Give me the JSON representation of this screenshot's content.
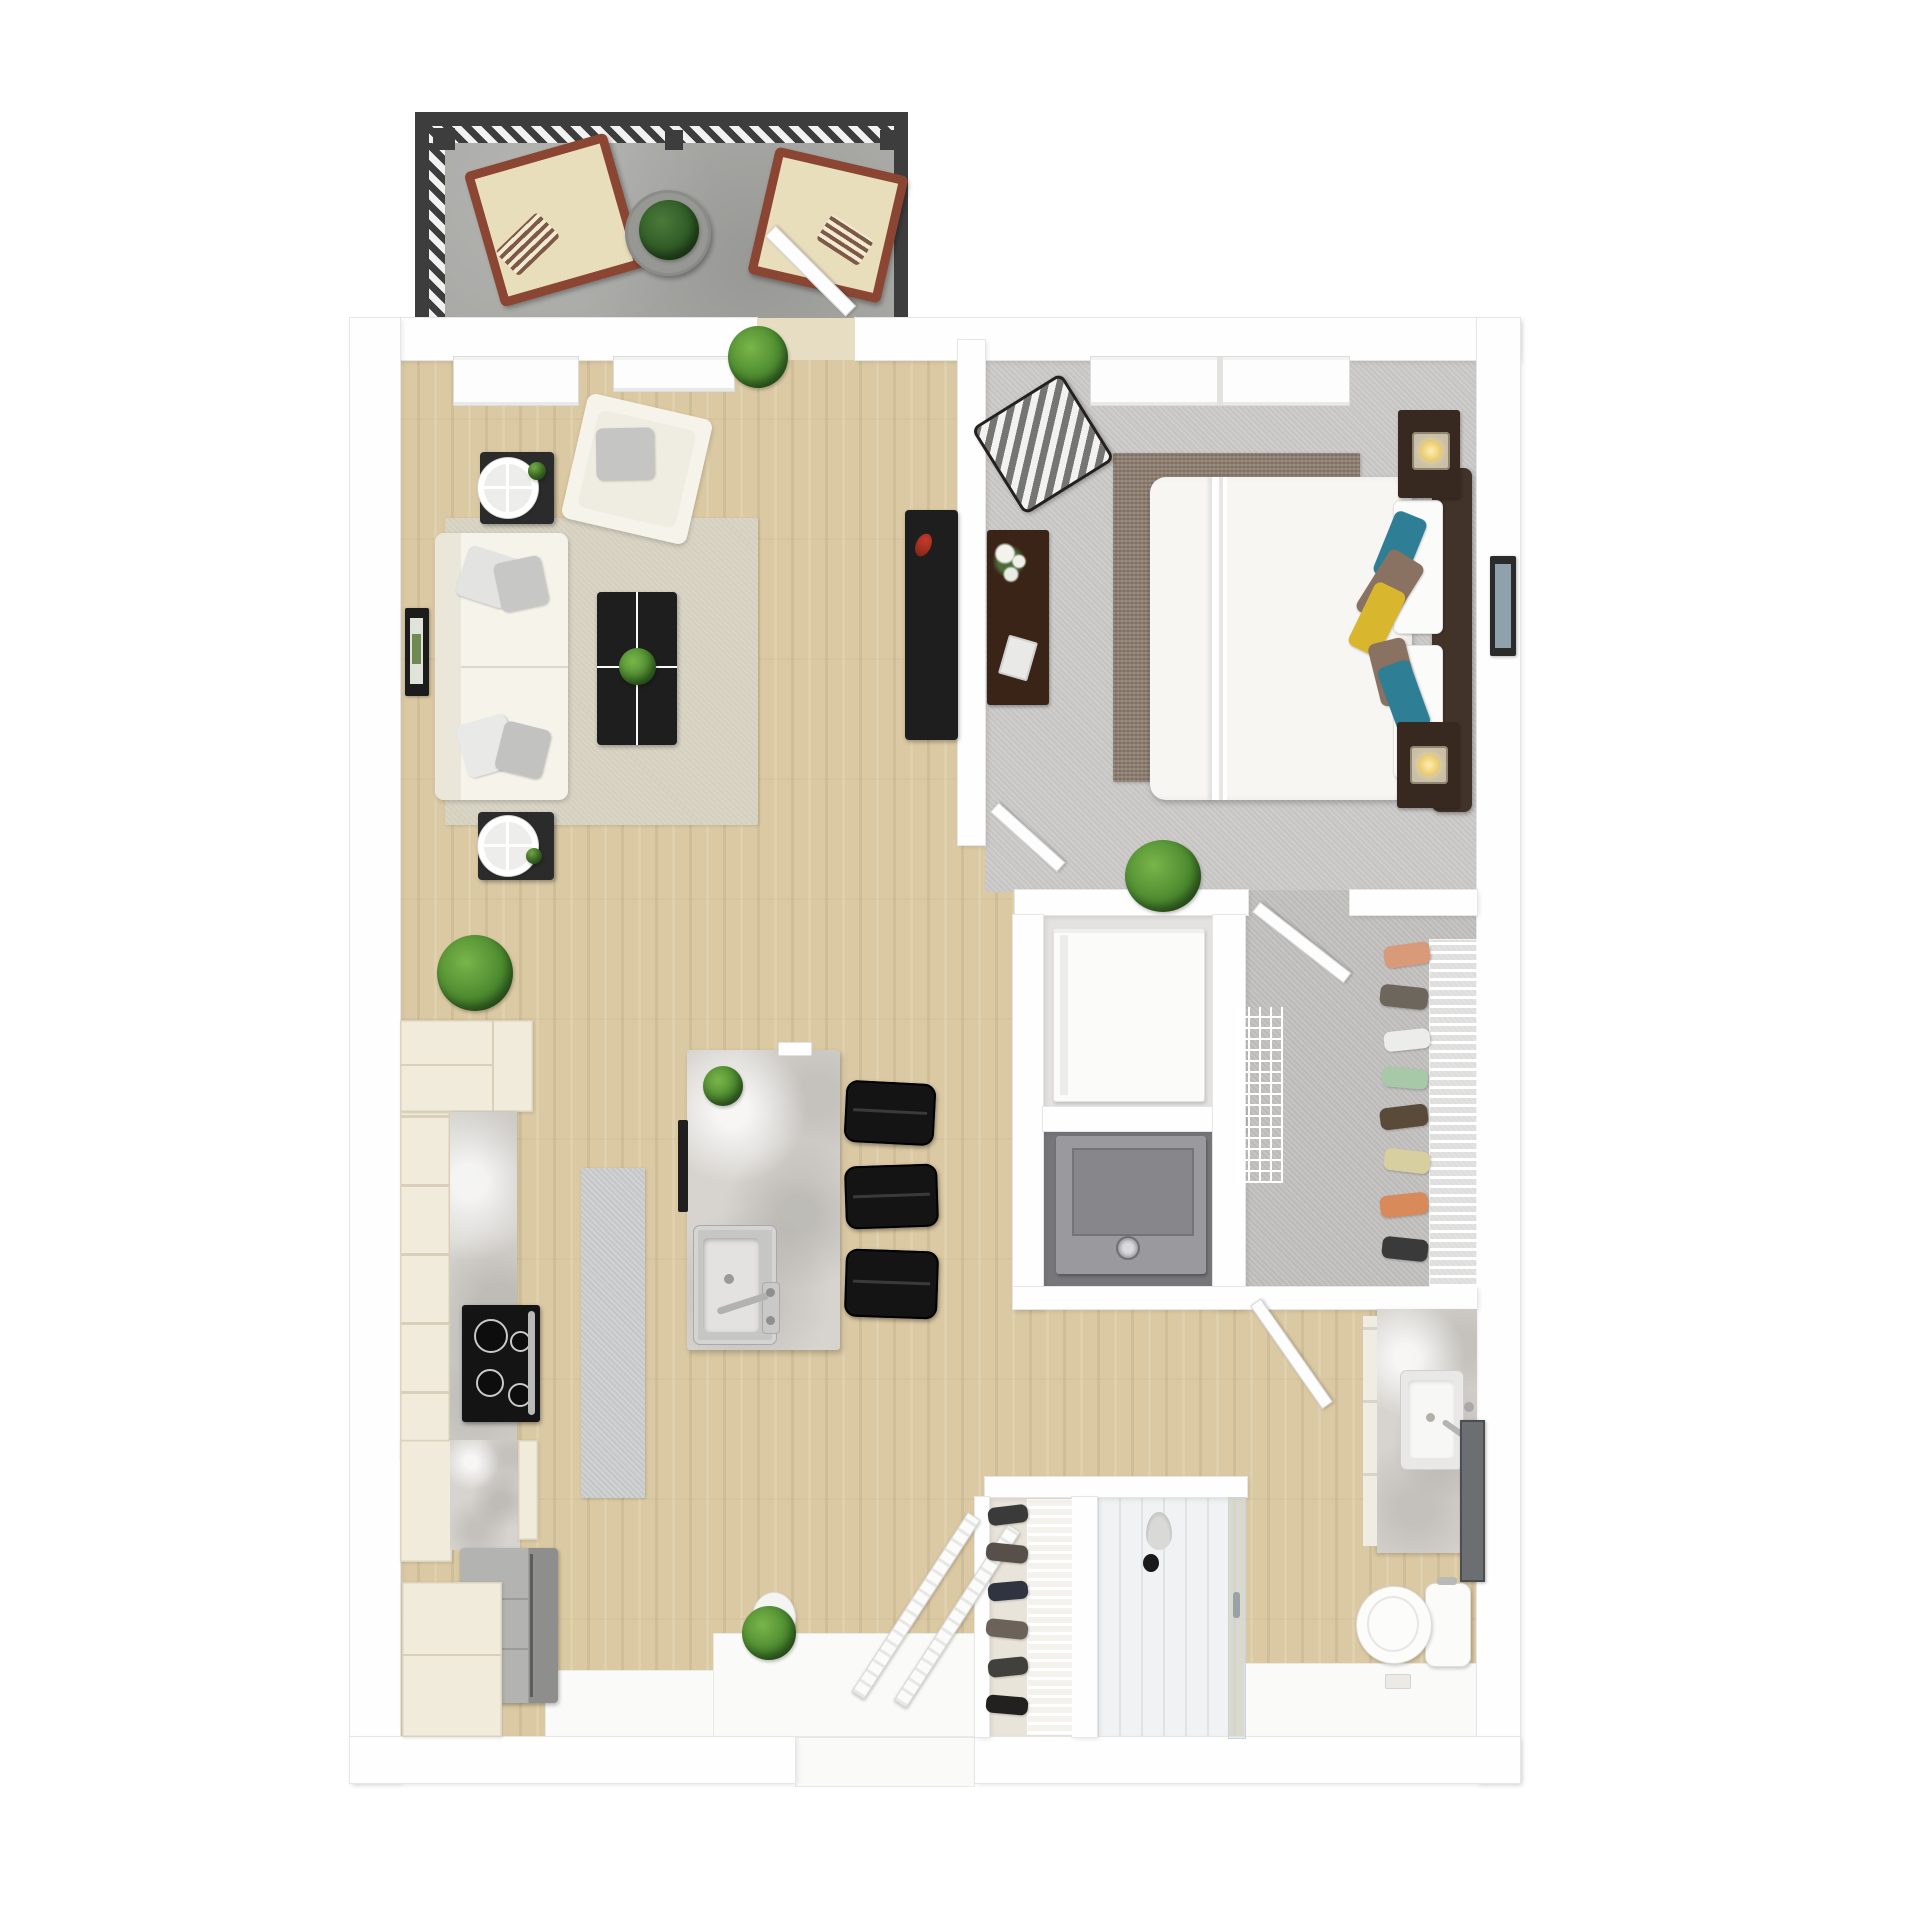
{
  "meta": {
    "label": "Top-down 3D rendered floor plan of a one-bedroom apartment with balcony",
    "render_style": "3d-dollhouse"
  },
  "palette": {
    "wall": "#fefefe",
    "wood_floor": "#dbc9a3",
    "bedroom_carpet": "#cbcac8",
    "closet_carpet": "#c2c1bf",
    "balcony_concrete": "#a9a9a6",
    "marble_counter": "#d7d4cf",
    "living_rug": "#d8d3c3",
    "bedroom_rug": "#8b7b6d",
    "runner_rug": "#caccce",
    "cream_cabinet": "#f1ebdb",
    "dark_wood": "#37291f",
    "black_furniture": "#1e1e1e",
    "white_upholstery": "#f6f3ea",
    "accent_teal": "#2e7f96",
    "accent_yellow": "#d8b62e",
    "accent_brown": "#8a7263",
    "railing_dark": "#3d3d3d",
    "plant_green": "#4c8a2f",
    "stainless": "#a9a9a7"
  },
  "rooms": {
    "balcony": {
      "label": "Balcony",
      "floor": "concrete",
      "items": [
        "slatted railing",
        "wood lounge chair with striped pillow",
        "wood lounge chair with striped pillow",
        "round glass table",
        "potted plant",
        "open balcony door"
      ]
    },
    "living_room": {
      "label": "Living room",
      "floor": "hardwood",
      "items": [
        "white loveseat with gray pillows",
        "white armchair with gray pillow",
        "black coffee table with plant",
        "beige area rug",
        "two dark side tables with round white lamps",
        "framed wall art",
        "black media console with red flower",
        "floor plants",
        "two windows"
      ]
    },
    "bedroom": {
      "label": "Bedroom",
      "floor": "carpet",
      "items": [
        "bed with white duvet",
        "dark headboard",
        "white pillows",
        "teal brown and yellow accent pillows",
        "two dark nightstands with glowing lamps",
        "dark dresser with flowers and book",
        "chevron accent chair",
        "brown area rug",
        "framed art on wall",
        "plant",
        "wide window"
      ]
    },
    "walk_in_closet": {
      "label": "Walk-in closet",
      "floor": "carpet",
      "items": [
        "white wire shoe rack with shoes",
        "wire shelf unit",
        "open door"
      ]
    },
    "utility_closets": {
      "label": "Utility / laundry closets",
      "items": [
        "white appliance",
        "gray washer-dryer with round knob"
      ]
    },
    "bathroom": {
      "label": "Bathroom",
      "floor": "hardwood and white tile",
      "items": [
        "marble vanity",
        "white sink with faucet",
        "leaning mirror",
        "toilet",
        "open door"
      ]
    },
    "shower": {
      "label": "Shower stall",
      "items": [
        "glass panel with handle",
        "pendant shower head"
      ]
    },
    "kitchen": {
      "label": "Kitchen",
      "floor": "hardwood",
      "items": [
        "cream cabinet run with marble counter",
        "black cooktop range",
        "stainless refrigerator",
        "cream corner cabinet",
        "marble island with sink and faucet",
        "three black bar stools",
        "gray runner rug",
        "plants"
      ]
    },
    "entry": {
      "label": "Entry",
      "items": [
        "open double doors",
        "white tile threshold",
        "shoe closet with wire rack",
        "round topiary on pedestal"
      ]
    }
  }
}
